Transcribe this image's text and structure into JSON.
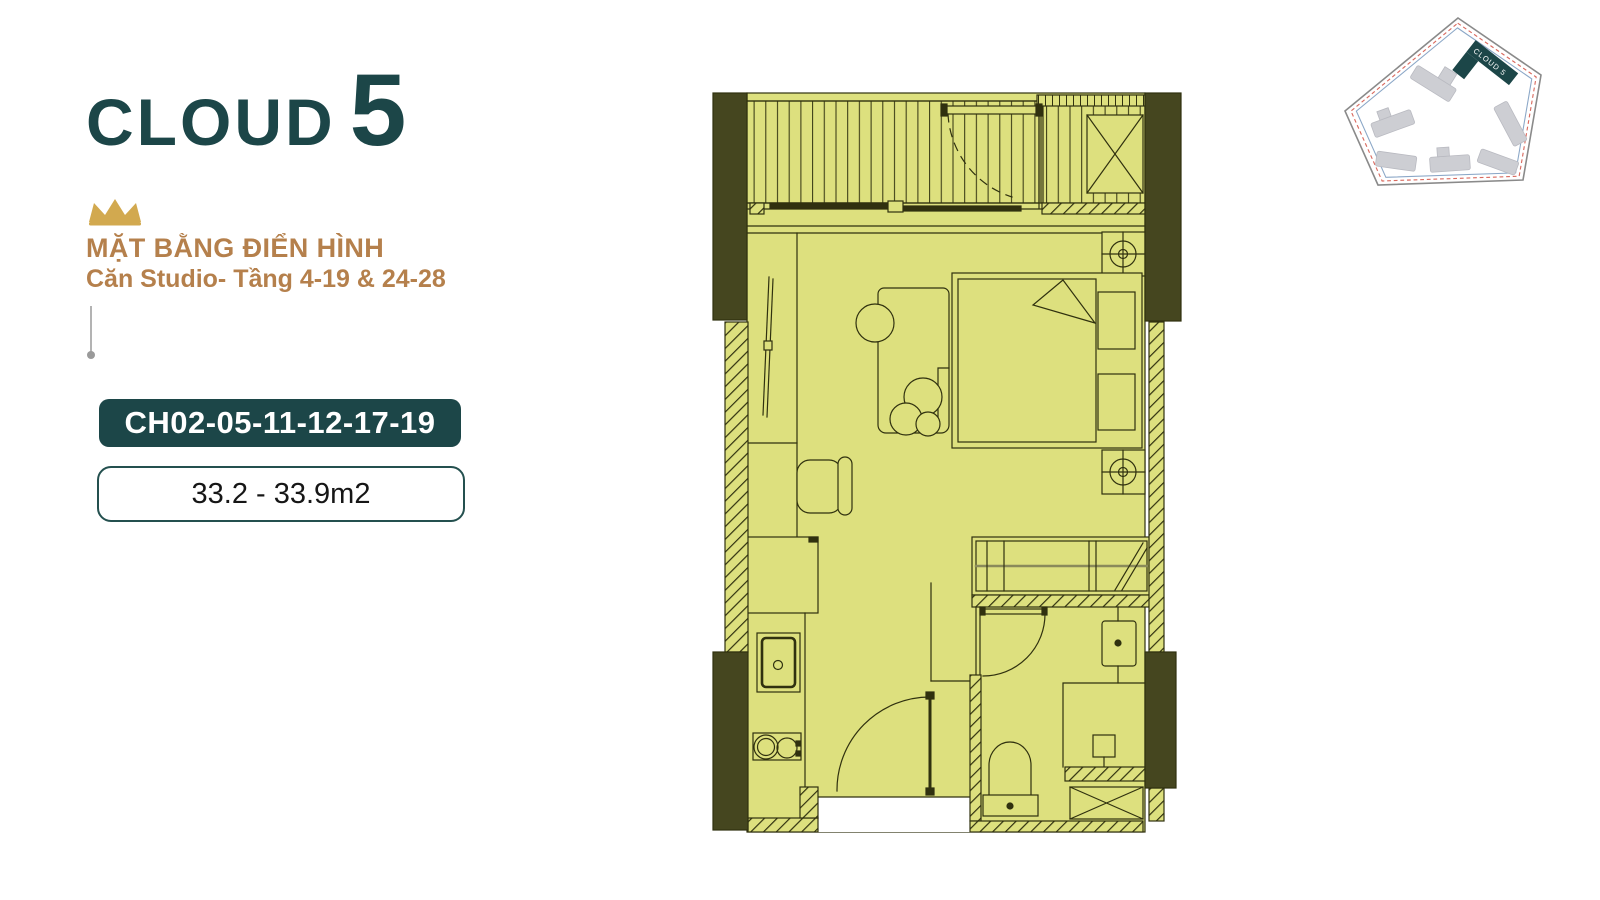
{
  "brand": {
    "name": "CLOUD",
    "number": "5"
  },
  "heading": {
    "line1": "MẶT BẰNG ĐIỂN HÌNH",
    "line2": "Căn Studio- Tầng 4-19 & 24-28"
  },
  "unit": {
    "code": "CH02-05-11-12-17-19",
    "area": "33.2 - 33.9m2"
  },
  "site_plan": {
    "building_label": "CLOUD 5"
  },
  "colors": {
    "teal": "#1c4648",
    "tan": "#b5804c",
    "gold": "#d2a94f",
    "plan_fill": "#dde07e",
    "plan_wall": "#45461f",
    "plan_line": "#30310f",
    "site_outline_gray": "#8a8a8a",
    "site_boundary_red": "#d96a5f",
    "site_boundary_blue": "#8ba7c7",
    "site_building_gray": "#cdced3"
  }
}
